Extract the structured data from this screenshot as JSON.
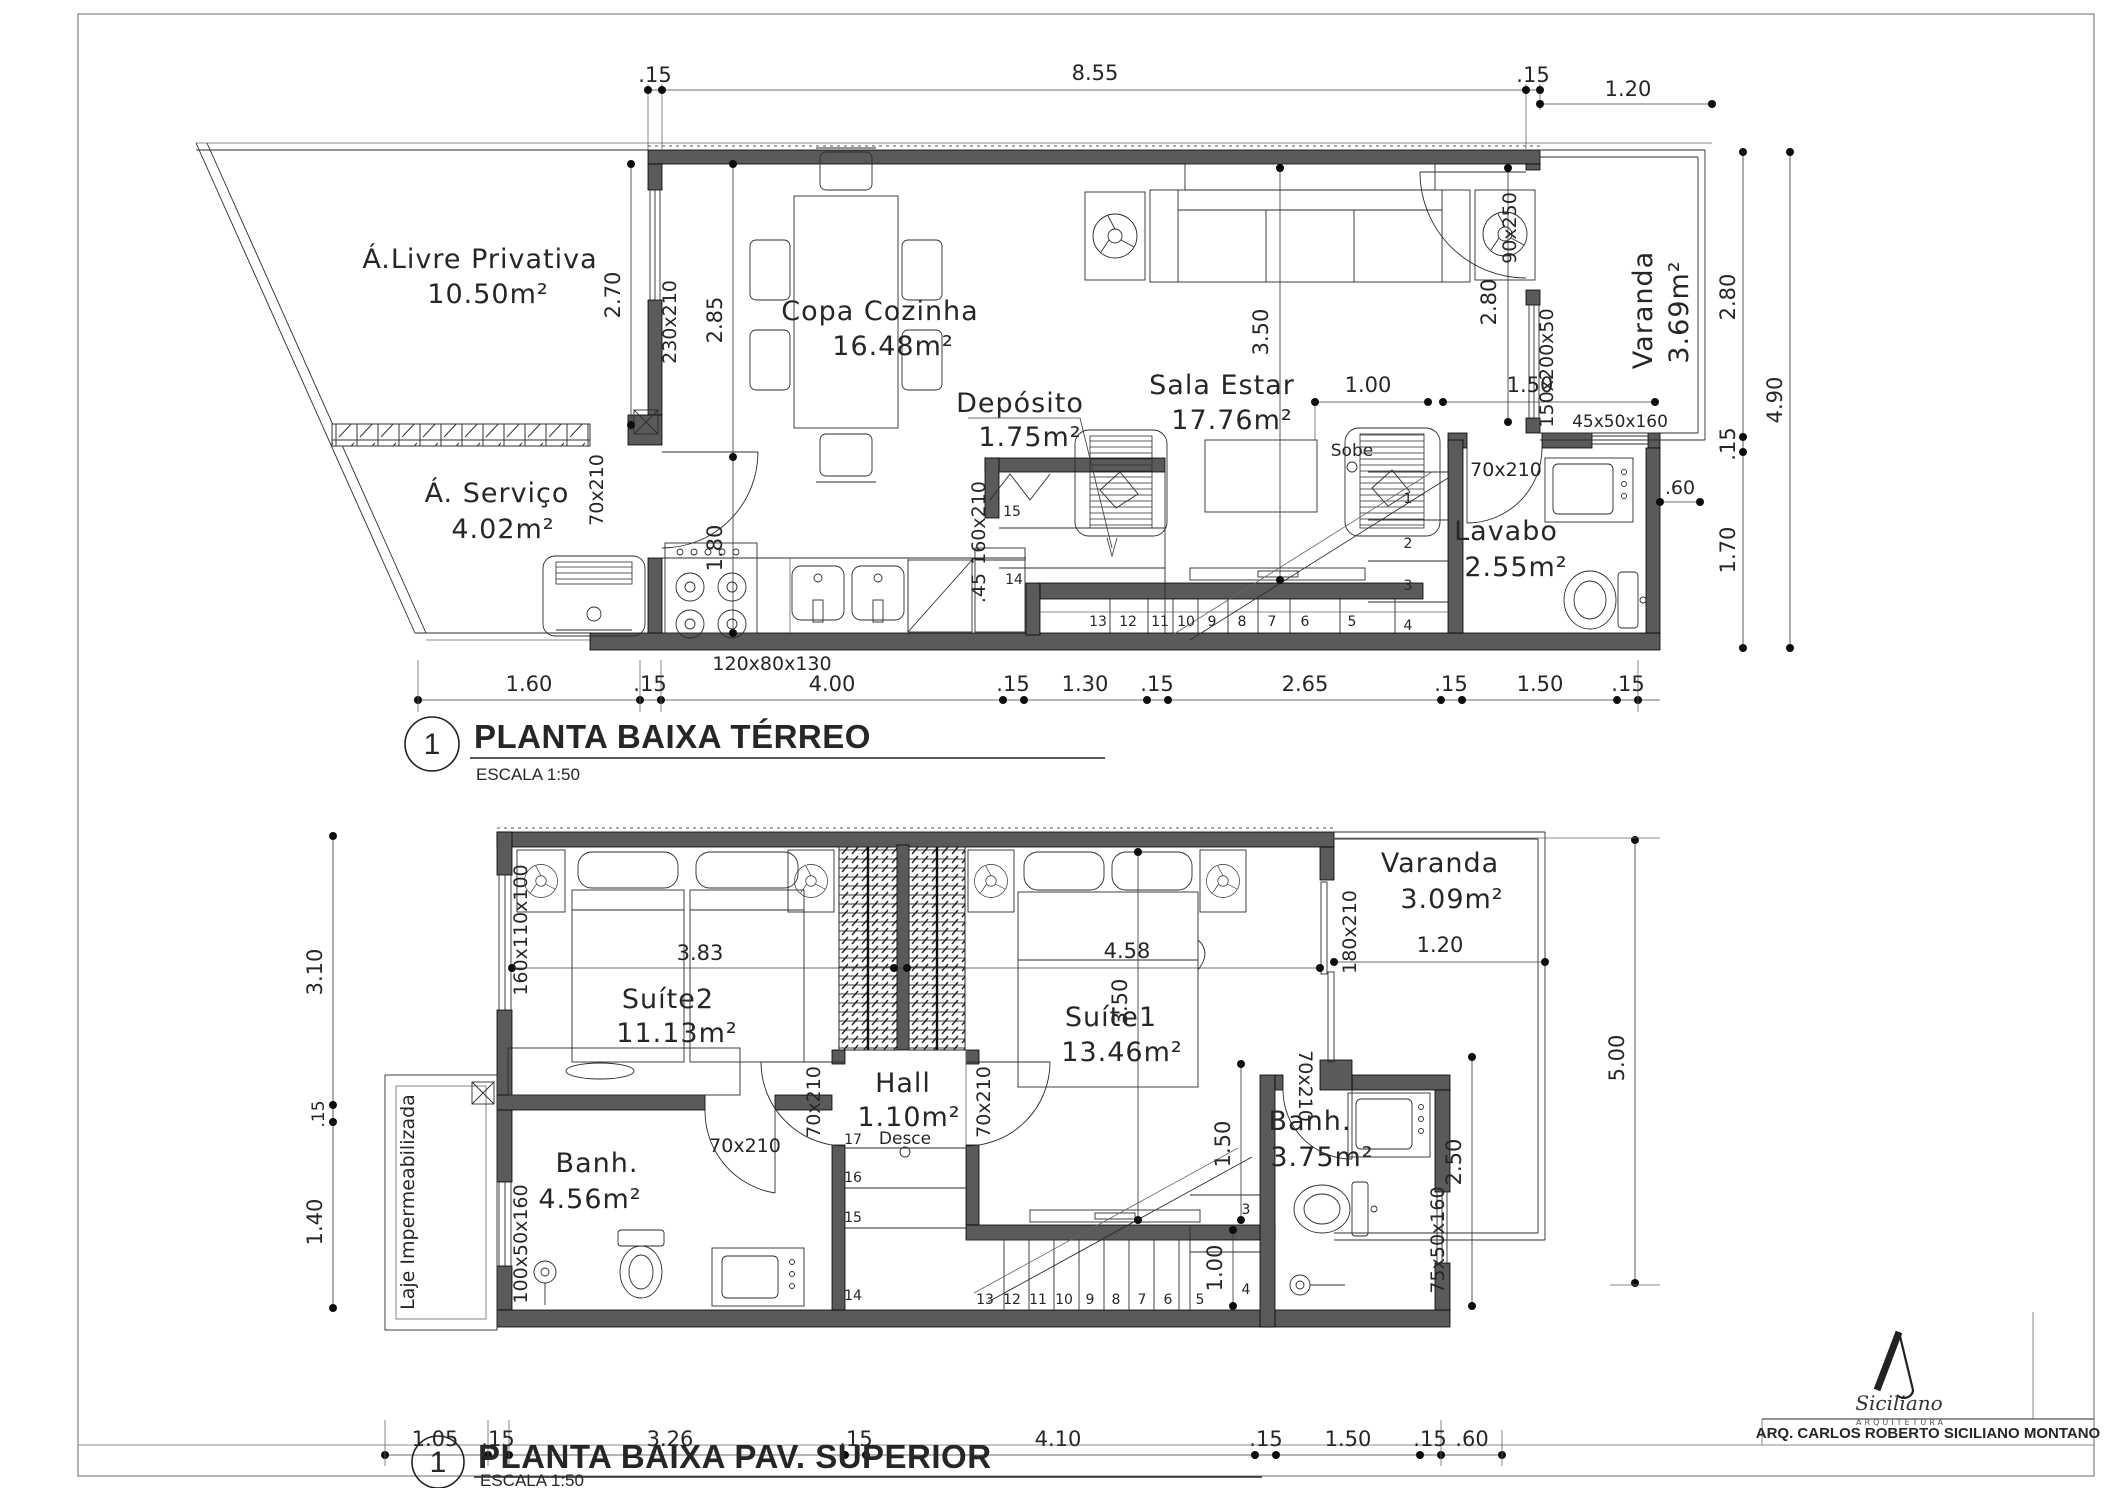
{
  "sheet": {
    "credit": "ARQ. CARLOS ROBERTO SICILIANO MONTANO",
    "logo_signature": "Siciliano",
    "logo_subtitle": "ARQUITETURA"
  },
  "terreo": {
    "view_number": "1",
    "title": "PLANTA BAIXA TÉRREO",
    "scale_label": "ESCALA  1:50",
    "rooms": {
      "livre_name": "Á.Livre  Privativa",
      "livre_area": "10.50m²",
      "servico_name": "Á.  Serviço",
      "servico_area": "4.02m²",
      "copa_name": "Copa  Cozinha",
      "copa_area": "16.48m²",
      "deposito_name": "Depósito",
      "deposito_area": "1.75m²",
      "sala_name": "Sala  Estar",
      "sala_area": "17.76m²",
      "lavabo_name": "Lavabo",
      "lavabo_area": "2.55m²",
      "varanda_name": "Varanda",
      "varanda_area": "3.69m²"
    },
    "stair_label": "Sobe",
    "stair_numbers": [
      "1",
      "2",
      "3",
      "4",
      "5",
      "6",
      "7",
      "8",
      "9",
      "10",
      "11",
      "12",
      "13",
      "14",
      "15"
    ],
    "dims": {
      "top_15_left": ".15",
      "top_855": "8.55",
      "top_15_right": ".15",
      "top_120": "1.20",
      "left_270": "2.70",
      "win_230x210": "230x210",
      "v_285": "2.85",
      "v_180": "1.80",
      "door_servico": "70x210",
      "v_350": "3.50",
      "v_280": "2.80",
      "door_varanda": "90x250",
      "win_150x200x50": "150x200x50",
      "h_100": "1.00",
      "h_150": "1.50",
      "win_45x50x160": "45x50x160",
      "door_lavabo": "70x210",
      "dep_160x210": "160x210",
      "dep_45": ".45",
      "counter_120x80x130": "120x80x130",
      "b_160": "1.60",
      "b_15a": ".15",
      "b_400": "4.00",
      "b_15b": ".15",
      "b_130": "1.30",
      "b_15c": ".15",
      "b_265": "2.65",
      "b_15d": ".15",
      "b_150": "1.50",
      "b_15e": ".15",
      "r_280": "2.80",
      "r_15": ".15",
      "r_170": "1.70",
      "r_490": "4.90",
      "r_60": ".60"
    }
  },
  "superior": {
    "view_number": "1",
    "title": "PLANTA BAIXA PAV. SUPERIOR",
    "scale_label": "ESCALA  1:50",
    "rooms": {
      "suite2_name": "Suíte2",
      "suite2_area": "11.13m²",
      "suite1_name": "Suíte1",
      "suite1_area": "13.46m²",
      "hall_name": "Hall",
      "hall_area": "1.10m²",
      "banh2_name": "Banh.",
      "banh2_area": "4.56m²",
      "banh1_name": "Banh.",
      "banh1_area": "3.75m²",
      "varanda_name": "Varanda",
      "varanda_area": "3.09m²",
      "laje": "Laje  Impermeabilizada"
    },
    "stair_label": "Desce",
    "stair_numbers": [
      "3",
      "4",
      "5",
      "6",
      "7",
      "8",
      "9",
      "10",
      "11",
      "12",
      "13",
      "14",
      "15",
      "16",
      "17"
    ],
    "dims": {
      "l_310": "3.10",
      "l_15": ".15",
      "l_140": "1.40",
      "win_160x110x100": "160x110x100",
      "win_100x50x160": "100x50x160",
      "h_383": "3.83",
      "h_458": "4.58",
      "h_120": "1.20",
      "door_180x210": "180x210",
      "door_hall_l": "70x210",
      "door_hall_r": "70x210",
      "door_banh2": "70x210",
      "door_banh1": "70x210",
      "v_350": "3.50",
      "v_150": "1.50",
      "v_250": "2.50",
      "v_100": "1.00",
      "win_75x50x160": "75x50x160",
      "r_500": "5.00",
      "b_105": "1.05",
      "b_15a": ".15",
      "b_326": "3.26",
      "b_15b": ".15",
      "b_410": "4.10",
      "b_15c": ".15",
      "b_150": "1.50",
      "b_15d": ".15",
      "b_60": ".60"
    }
  }
}
